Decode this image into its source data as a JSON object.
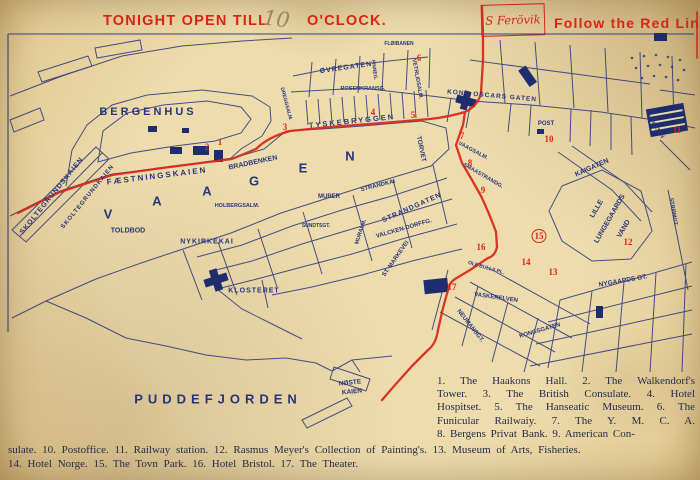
{
  "banner": {
    "tonight_open": "TONIGHT OPEN TILL",
    "hour_handwritten": "10",
    "oclock": "O'CLOCK.",
    "flag_label": "S Ferövik",
    "follow": "Follow the Red Line"
  },
  "colors": {
    "paper": "#eedcad",
    "map_ink": "#26357d",
    "route_red": "#d8261a",
    "banner_red": "#df2417",
    "pencil": "#9e8c66"
  },
  "legend": {
    "column_lines": [
      "1. The Haakons Hall. 2. The Walkendorf's",
      "Tower. 3. The British Consulate. 4. Hotel",
      "Hospitset. 5. The Hanseatic Museum. 6. The",
      "Funicular Railwaiy. 7. The Y. M. C. A.",
      "8. Bergens Privat Bank. 9. American Con-"
    ],
    "bottom_lines": [
      "sulate. 10. Postoffice. 11. Railway station. 12. Rasmus Meyer's Collection of Painting's. 13. Museum of Arts, Fisheries.",
      "14. Hotel Norge. 15. The Tovn Park. 16. Hotel Bristol. 17. The Theater."
    ]
  },
  "map": {
    "labels": [
      {
        "t": "BERGENHUS",
        "x": 148,
        "y": 112,
        "s": 11,
        "ls": 3
      },
      {
        "t": "FÆSTNINGSKAIEN",
        "x": 157,
        "y": 176,
        "s": 8,
        "ls": 2,
        "r": -7
      },
      {
        "t": "SKOLTEGRUNDSKAIEN",
        "x": 52,
        "y": 196,
        "s": 7,
        "ls": 1,
        "r": -51
      },
      {
        "t": "SKOLTEGRUNDKAIEN",
        "x": 88,
        "y": 197,
        "s": 6,
        "ls": 1,
        "r": -51
      },
      {
        "t": "BRADBENKEN",
        "x": 253,
        "y": 163,
        "s": 7,
        "r": -12
      },
      {
        "t": "V",
        "x": 108,
        "y": 214,
        "s": 13
      },
      {
        "t": "A",
        "x": 157,
        "y": 201,
        "s": 13
      },
      {
        "t": "A",
        "x": 207,
        "y": 191,
        "s": 13
      },
      {
        "t": "G",
        "x": 254,
        "y": 181,
        "s": 13
      },
      {
        "t": "E",
        "x": 303,
        "y": 168,
        "s": 13
      },
      {
        "t": "N",
        "x": 350,
        "y": 156,
        "s": 13
      },
      {
        "t": "TOLDBOD",
        "x": 128,
        "y": 231,
        "s": 7
      },
      {
        "t": "NYKIRKEKAI",
        "x": 207,
        "y": 242,
        "s": 7,
        "ls": 1
      },
      {
        "t": "HOLBERGSALM.",
        "x": 237,
        "y": 206,
        "s": 5.5
      },
      {
        "t": "MURER",
        "x": 329,
        "y": 197,
        "s": 6
      },
      {
        "t": "STRANDKAI",
        "x": 378,
        "y": 186,
        "s": 6,
        "r": -14
      },
      {
        "t": "STRANDGATEN",
        "x": 412,
        "y": 208,
        "s": 7,
        "ls": 1,
        "r": -24
      },
      {
        "t": "VALCKEN-DORFFG.",
        "x": 404,
        "y": 229,
        "s": 6,
        "r": -16
      },
      {
        "t": "ST. MARKEVEI",
        "x": 396,
        "y": 259,
        "s": 6,
        "r": -55
      },
      {
        "t": "MURALM.",
        "x": 361,
        "y": 232,
        "s": 5.5,
        "r": -72
      },
      {
        "t": "TORVET",
        "x": 421,
        "y": 149,
        "s": 6.5,
        "r": 78
      },
      {
        "t": "TYSKEBRYGGEN",
        "x": 352,
        "y": 121,
        "s": 7.5,
        "ls": 2,
        "r": -6
      },
      {
        "t": "ØVREGATEN",
        "x": 346,
        "y": 68,
        "s": 7,
        "ls": 1,
        "r": -8
      },
      {
        "t": "FLØIBANEN",
        "x": 399,
        "y": 44,
        "s": 5
      },
      {
        "t": "ROSENKRANSG.",
        "x": 363,
        "y": 89,
        "s": 5.5
      },
      {
        "t": "KONG OSCARS GATEN",
        "x": 492,
        "y": 96,
        "s": 6.5,
        "ls": 1,
        "r": 5
      },
      {
        "t": "VETRLIDSALM.",
        "x": 417,
        "y": 79,
        "s": 5.5,
        "r": 80
      },
      {
        "t": "FINNEG.",
        "x": 374,
        "y": 70,
        "s": 5,
        "r": 82
      },
      {
        "t": "DREGGSALM.",
        "x": 286,
        "y": 104,
        "s": 5,
        "r": 75
      },
      {
        "t": "POST",
        "x": 546,
        "y": 124,
        "s": 6
      },
      {
        "t": "KAIGATEN",
        "x": 592,
        "y": 168,
        "s": 7,
        "r": -24
      },
      {
        "t": "LILLE",
        "x": 597,
        "y": 209,
        "s": 7,
        "r": -60
      },
      {
        "t": "LUNGEGAARDS",
        "x": 610,
        "y": 219,
        "s": 7,
        "r": -60
      },
      {
        "t": "VAND",
        "x": 624,
        "y": 229,
        "s": 7,
        "r": -60
      },
      {
        "t": "VAAGSALM.",
        "x": 473,
        "y": 151,
        "s": 5.5,
        "r": 28
      },
      {
        "t": "SMAASTRANDG.",
        "x": 483,
        "y": 176,
        "s": 5.5,
        "r": 30
      },
      {
        "t": "OLE BULLS PL.",
        "x": 486,
        "y": 268,
        "s": 5,
        "r": 16
      },
      {
        "t": "VASKERELVEN",
        "x": 496,
        "y": 298,
        "s": 6,
        "r": 8
      },
      {
        "t": "NEUMANSGT.",
        "x": 470,
        "y": 326,
        "s": 6,
        "r": 52
      },
      {
        "t": "KONGSGATEN",
        "x": 540,
        "y": 331,
        "s": 6,
        "r": -16
      },
      {
        "t": "NYGAARDS GT.",
        "x": 623,
        "y": 281,
        "s": 6.5,
        "r": -10
      },
      {
        "t": "STRØMGT.",
        "x": 673,
        "y": 212,
        "s": 5.5,
        "r": 80
      },
      {
        "t": "NYGATEN",
        "x": 655,
        "y": 127,
        "s": 5.5,
        "r": 55
      },
      {
        "t": "SUNDTSGT.",
        "x": 316,
        "y": 226,
        "s": 5
      },
      {
        "t": "KLOSTERET",
        "x": 254,
        "y": 291,
        "s": 7,
        "ls": 1
      },
      {
        "t": "NØSTE",
        "x": 350,
        "y": 383,
        "s": 6.5,
        "r": -6
      },
      {
        "t": "KAIEN",
        "x": 352,
        "y": 392,
        "s": 6.5,
        "r": -6
      },
      {
        "t": "PUDDEFJORDEN",
        "x": 218,
        "y": 399,
        "s": 13,
        "ls": 5
      }
    ],
    "markers": [
      {
        "n": "1",
        "x": 220,
        "y": 142
      },
      {
        "n": "2",
        "x": 207,
        "y": 147
      },
      {
        "n": "3",
        "x": 285,
        "y": 127
      },
      {
        "n": "4",
        "x": 373,
        "y": 112
      },
      {
        "n": "5",
        "x": 413,
        "y": 115
      },
      {
        "n": "6",
        "x": 419,
        "y": 58
      },
      {
        "n": "7",
        "x": 462,
        "y": 136
      },
      {
        "n": "8",
        "x": 470,
        "y": 163
      },
      {
        "n": "9",
        "x": 483,
        "y": 190
      },
      {
        "n": "10",
        "x": 549,
        "y": 139
      },
      {
        "n": "11",
        "x": 677,
        "y": 130
      },
      {
        "n": "12",
        "x": 628,
        "y": 242
      },
      {
        "n": "13",
        "x": 553,
        "y": 272
      },
      {
        "n": "14",
        "x": 526,
        "y": 262
      },
      {
        "n": "15",
        "x": 539,
        "y": 236,
        "circled": true
      },
      {
        "n": "16",
        "x": 481,
        "y": 247
      },
      {
        "n": "17",
        "x": 452,
        "y": 287
      }
    ]
  }
}
